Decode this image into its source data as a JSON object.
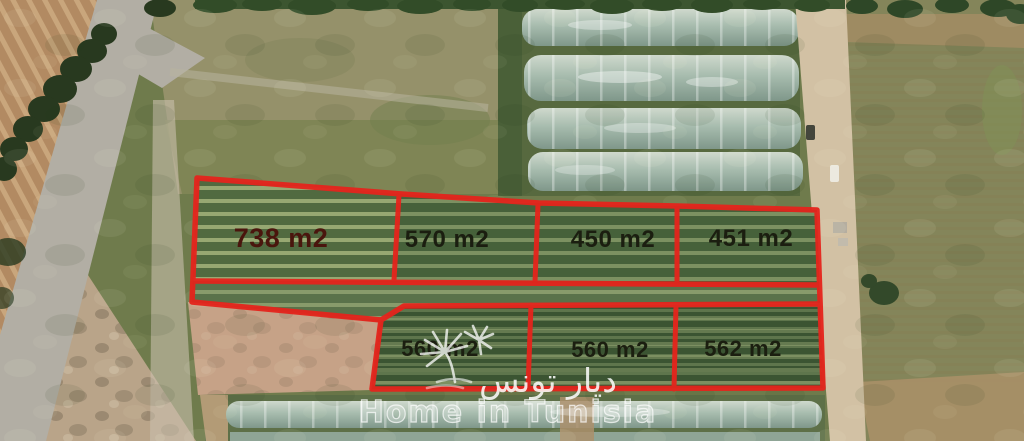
{
  "image": {
    "kind": "satellite-photo-of-land-plots",
    "width": 1024,
    "height": 441
  },
  "plots": {
    "unit": "m2",
    "row_top": [
      {
        "area_label": "738 m2"
      },
      {
        "area_label": "570 m2"
      },
      {
        "area_label": "450 m2"
      },
      {
        "area_label": "451 m2"
      }
    ],
    "row_bottom": [
      {
        "area_label": "560 m2"
      },
      {
        "area_label": "560 m2"
      },
      {
        "area_label": "562 m2"
      }
    ]
  },
  "watermark": {
    "logo_icon": "palm-tree-icon",
    "arabic_text": "ديار تونس",
    "english_text": "Home in Tunisia"
  },
  "colors": {
    "plot_boundary": "#e5241c",
    "label_text": "#1b1e10",
    "label_text_primary": "#4a150d",
    "watermark_text": "#ffffff"
  }
}
